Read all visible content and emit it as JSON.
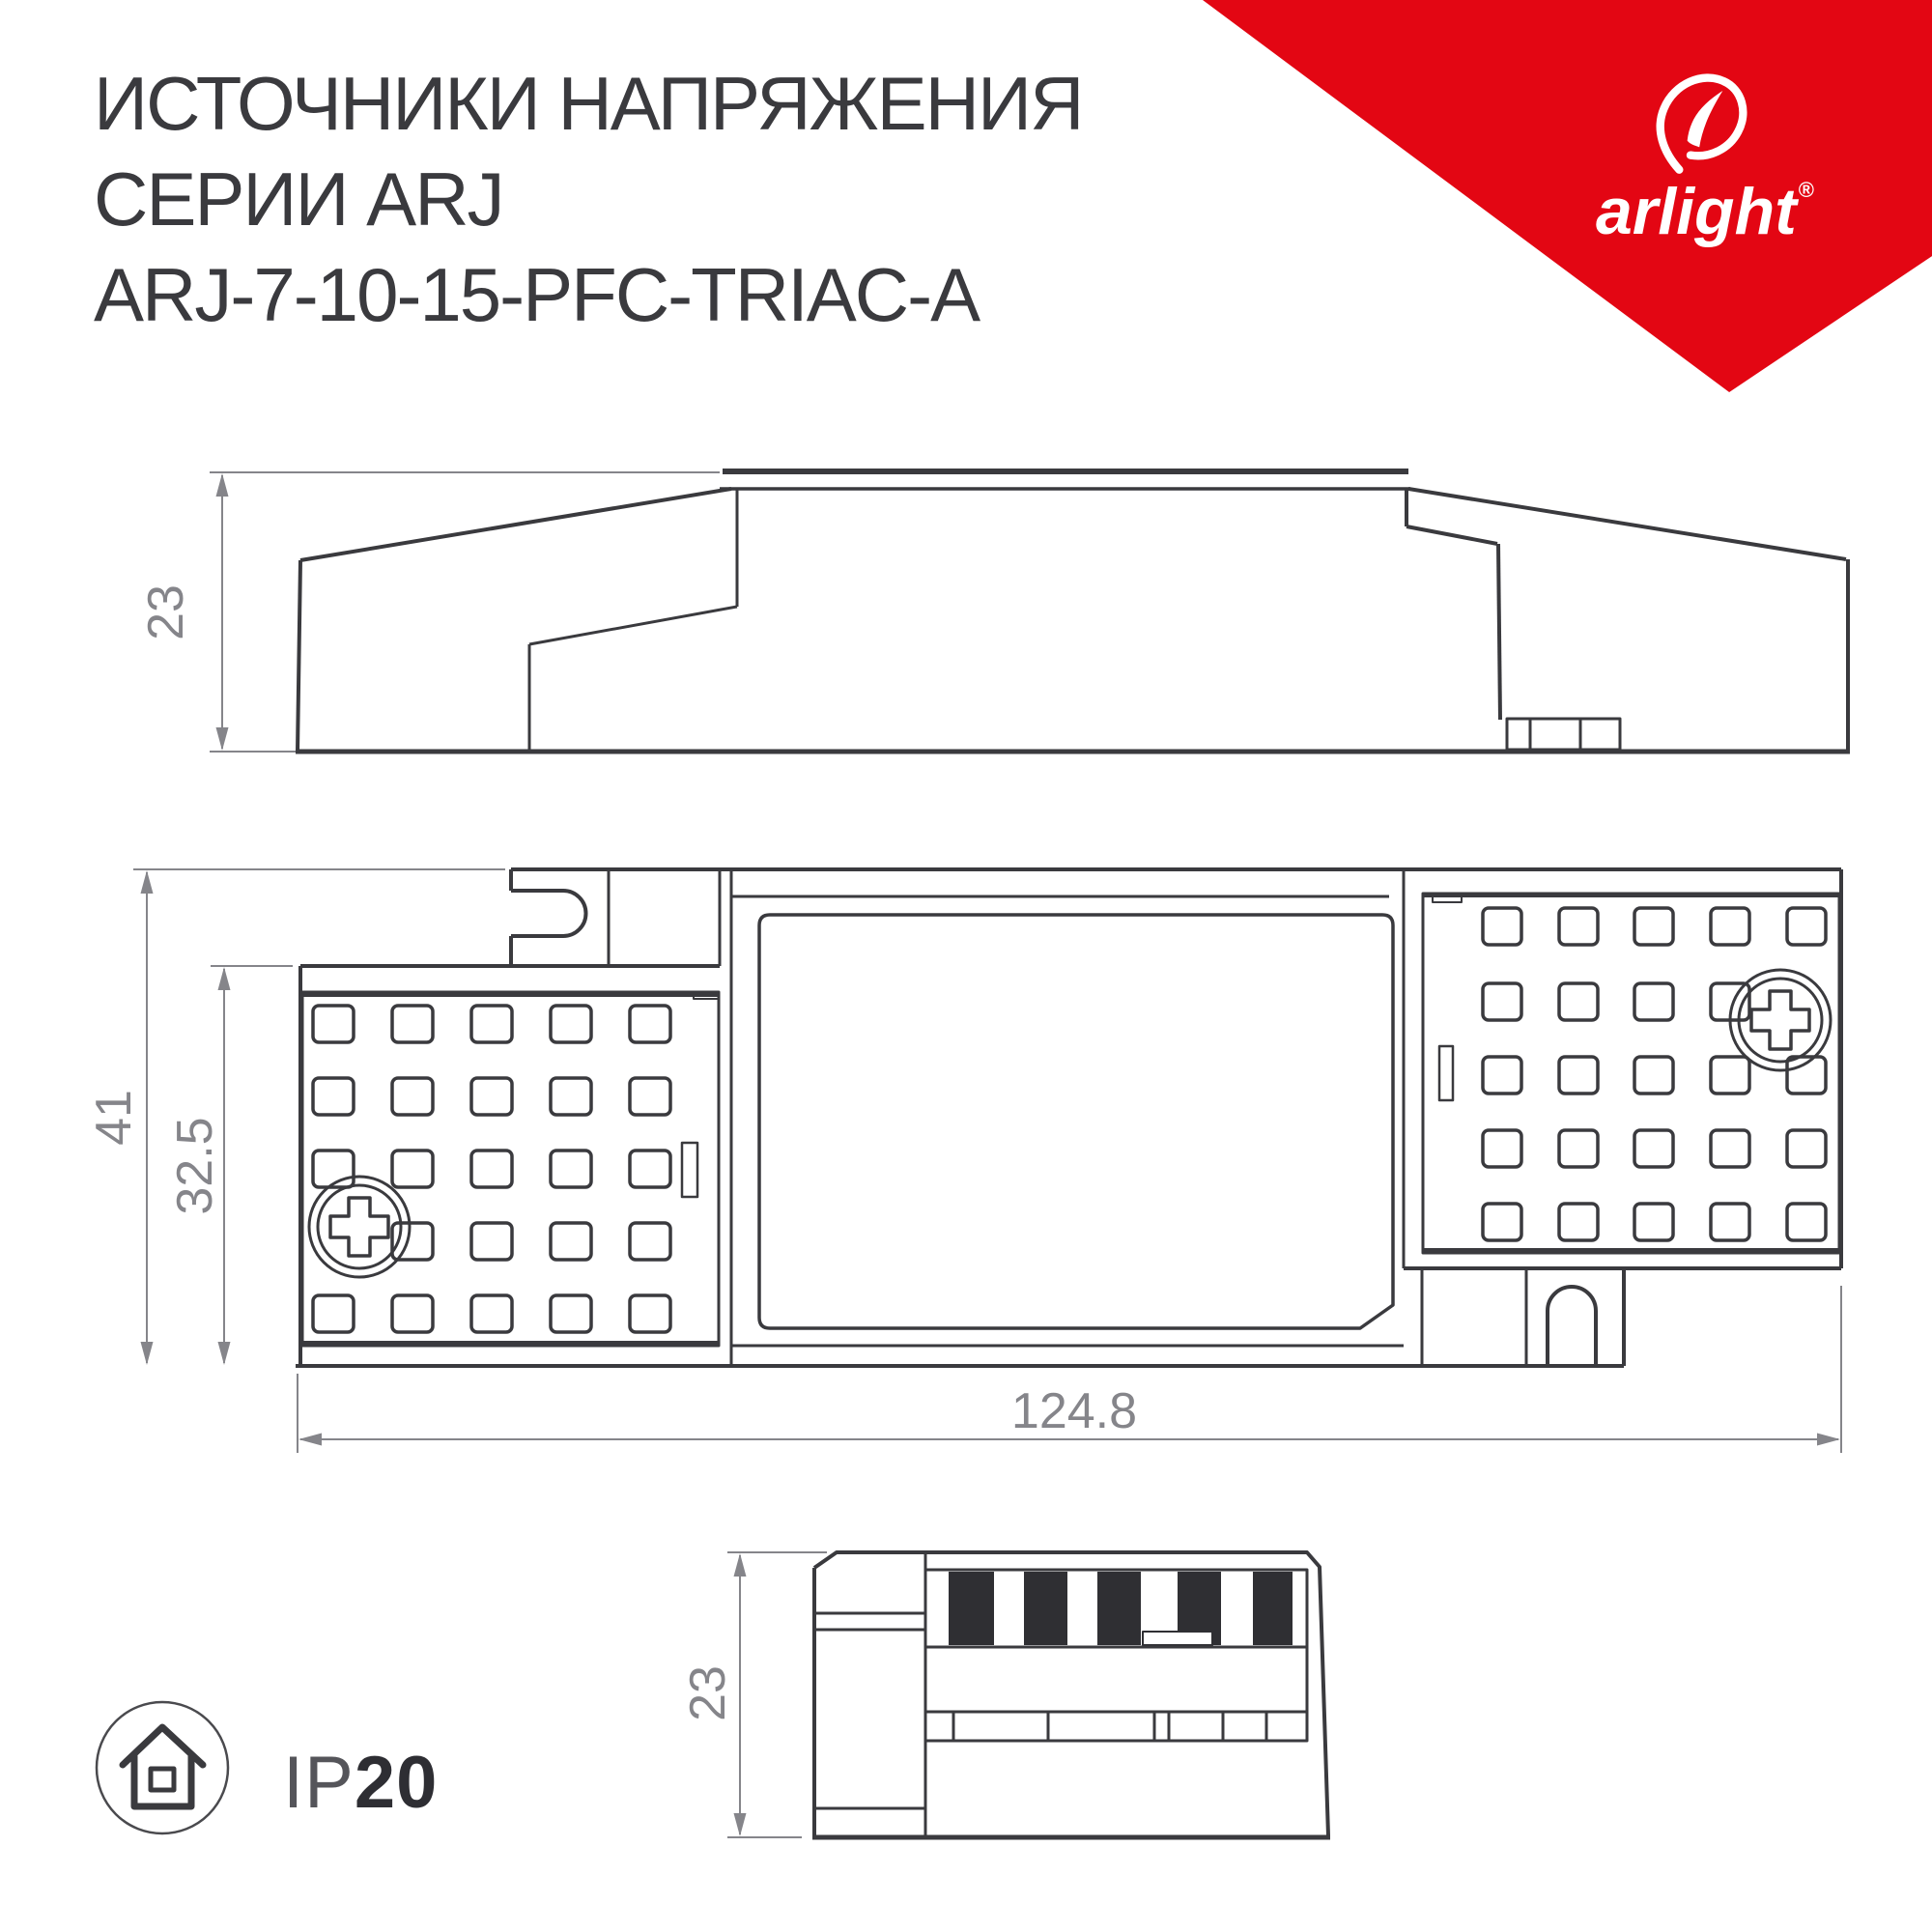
{
  "header": {
    "title_line1": "ИСТОЧНИКИ НАПРЯЖЕНИЯ",
    "title_line2": "СЕРИИ ARJ",
    "title_line3": "ARJ-7-10-15-PFC-TRIAC-A"
  },
  "brand": {
    "logo_text": "arlight",
    "registered_mark": "®"
  },
  "drawings": {
    "side_view": {
      "height_label": "23"
    },
    "plan_view": {
      "overall_height_label": "41",
      "body_height_label": "32.5",
      "overall_width_label": "124.8"
    },
    "end_view": {
      "height_label": "23"
    }
  },
  "footer": {
    "ip_prefix": "IP",
    "ip_value": "20"
  },
  "colors": {
    "accent_red": "#e30613",
    "drawing_line": "#3a3a3e",
    "dimension_gray": "#85858a",
    "terminal_stripe": "#2f2f33"
  }
}
